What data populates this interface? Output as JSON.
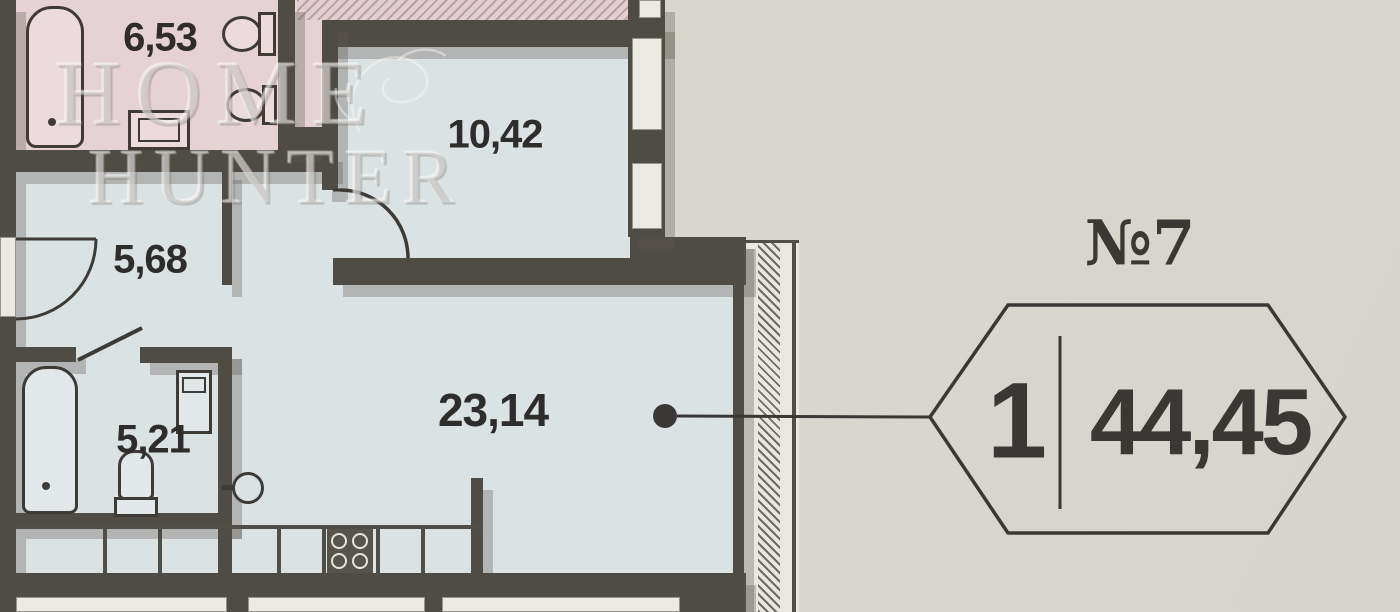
{
  "plan": {
    "watermark": {
      "line1": "HOME",
      "line2": "HUNTER"
    },
    "rooms": [
      {
        "id": "bathroom-top",
        "type": "bathroom",
        "area_label": "6,53"
      },
      {
        "id": "bedroom",
        "type": "room",
        "area_label": "10,42"
      },
      {
        "id": "hallway",
        "type": "hallway",
        "area_label": "5,68"
      },
      {
        "id": "bathroom-lower",
        "type": "bathroom",
        "area_label": "5,21"
      },
      {
        "id": "living-kitchen",
        "type": "living-kitchen",
        "area_label": "23,14"
      }
    ],
    "colors": {
      "wet_zone": "#e6d2d5",
      "living_zone": "#dbe2e3",
      "wall": "#4f4b45",
      "paper": "#d8d5cf"
    }
  },
  "callout": {
    "apartment_label": "№7",
    "rooms_count": "1",
    "total_area": "44,45"
  }
}
